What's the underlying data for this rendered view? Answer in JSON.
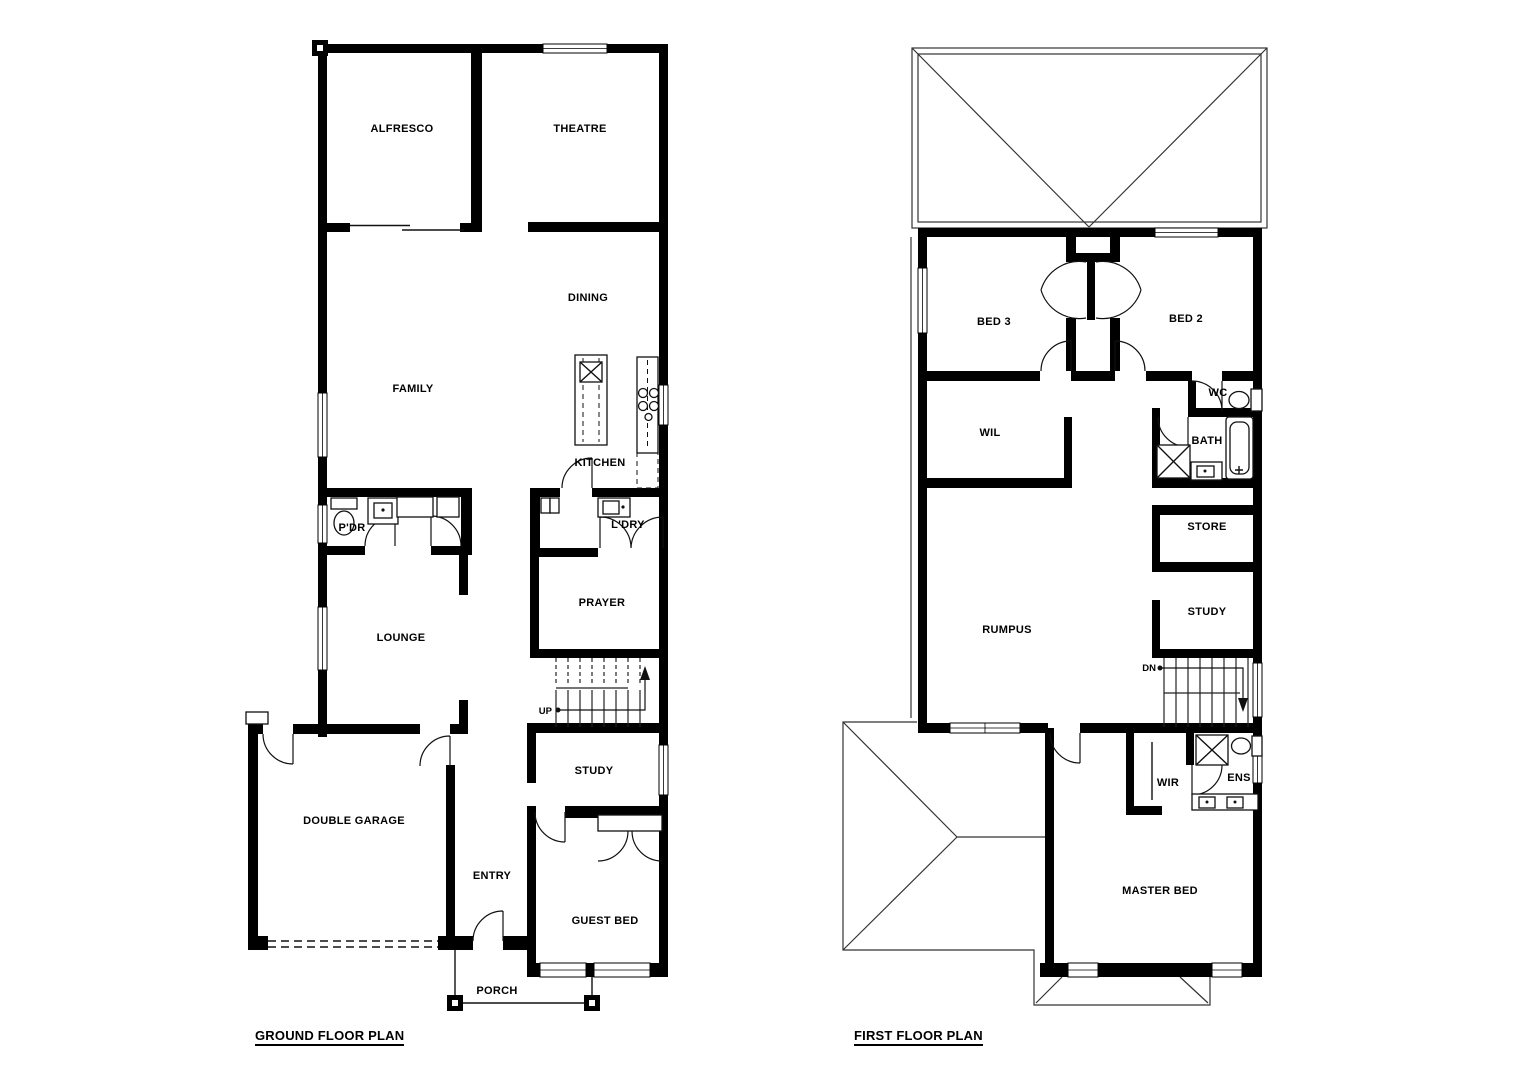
{
  "colors": {
    "walls": "#000000",
    "background": "#ffffff",
    "roof_lines": "#333333"
  },
  "ground_floor": {
    "title": "GROUND FLOOR PLAN",
    "stair_direction": "UP",
    "rooms": {
      "alfresco": "ALFRESCO",
      "theatre": "THEATRE",
      "dining": "DINING",
      "family": "FAMILY",
      "kitchen": "KITCHEN",
      "pdr": "P'DR",
      "ldry": "L'DRY",
      "lounge": "LOUNGE",
      "prayer": "PRAYER",
      "study": "STUDY",
      "double_garage": "DOUBLE GARAGE",
      "entry": "ENTRY",
      "guest_bed": "GUEST BED",
      "porch": "PORCH"
    }
  },
  "first_floor": {
    "title": "FIRST FLOOR PLAN",
    "stair_direction": "DN",
    "rooms": {
      "bed3": "BED 3",
      "bed2": "BED 2",
      "wc": "WC",
      "wil": "WIL",
      "bath": "BATH",
      "store": "STORE",
      "study": "STUDY",
      "rumpus": "RUMPUS",
      "wir": "WIR",
      "ens": "ENS",
      "master_bed": "MASTER BED"
    }
  }
}
